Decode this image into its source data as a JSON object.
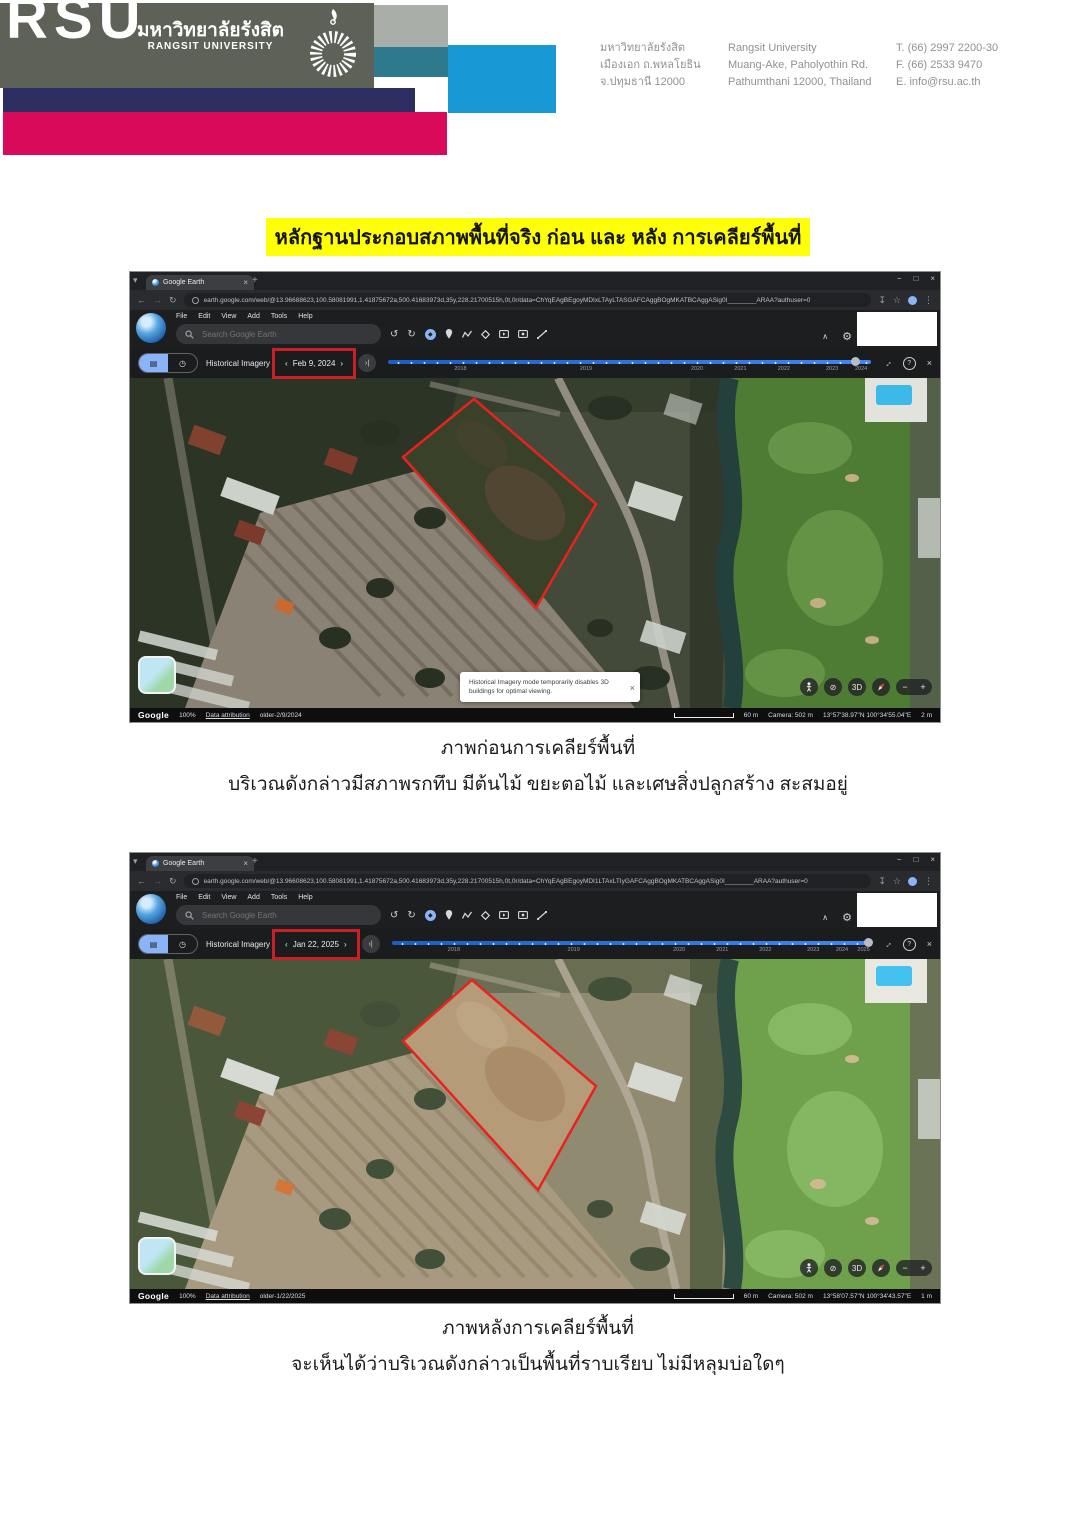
{
  "header": {
    "logo_acronym": "RSU",
    "name_thai": "มหาวิทยาลัยรังสิต",
    "name_en": "RANGSIT UNIVERSITY",
    "address_thai": {
      "l1": "มหาวิทยาลัยรังสิต",
      "l2": "เมืองเอก ถ.พหลโยธิน",
      "l3": "จ.ปทุมธานี 12000"
    },
    "address_en": {
      "l1": "Rangsit University",
      "l2": "Muang-Ake, Paholyothin Rd.",
      "l3": "Pathumthani 12000, Thailand"
    },
    "contact": {
      "l1": "T.  (66) 2997 2200-30",
      "l2": "F.  (66) 2533 9470",
      "l3": "E.  info@rsu.ac.th"
    },
    "colors": {
      "olive": "#5e6157",
      "gray": "#a9aea8",
      "teal": "#2e7a8c",
      "blue": "#1899d6",
      "navy": "#2c2e62",
      "magenta": "#da0a5b",
      "highlight": "#ffff06",
      "annotation_red": "#c91f25",
      "parcel_red": "#e8231d"
    }
  },
  "doc_title": "หลักฐานประกอบสภาพพื้นที่จริง ก่อน และ หลัง การเคลียร์พื้นที่",
  "browser": {
    "tab_title": "Google Earth",
    "menu": [
      "File",
      "Edit",
      "View",
      "Add",
      "Tools",
      "Help"
    ],
    "search_placeholder": "Search Google Earth"
  },
  "shot1": {
    "url": "earth.google.com/web/@13.96688623,100.58081991,1.41875672a,500.41683973d,35y,228.21700515h,0t,0r/data=ChYqEAgBEgoyMDIxLTAyLTASGAFCAggBOgMKATBCAggASig0I________ARAA?authuser=0",
    "mode_label": "Historical Imagery",
    "date": "Feb 9, 2024",
    "timeline_years": [
      "2018",
      "2019",
      "2020",
      "2021",
      "2022",
      "2023",
      "2024"
    ],
    "toast_line1": "Historical Imagery mode temporarily disables 3D",
    "toast_line2": "buildings for optimal viewing.",
    "status": {
      "brand": "Google",
      "zoom": "100%",
      "attribution": "Data attribution",
      "older": "older-2/9/2024",
      "scale": "60 m",
      "camera": "Camera: 502 m",
      "coords": "13°57'38.97\"N 100°34'55.04\"E",
      "altitude": "2 m"
    }
  },
  "shot2": {
    "url": "earth.google.com/web/@13.96608623,100.58081991,1.41875672a,500.41683973d,35y,228.21700515h,0t,0r/data=ChYqEAgBEgoyMDI1LTAxLTIyGAFCAggBOgMKATBCAggASig0I________ARAA?authuser=0",
    "mode_label": "Historical Imagery",
    "date": "Jan 22, 2025",
    "timeline_years": [
      "2018",
      "2019",
      "2020",
      "2021",
      "2022",
      "2023",
      "2024",
      "2025"
    ],
    "status": {
      "brand": "Google",
      "zoom": "100%",
      "attribution": "Data attribution",
      "older": "older-1/22/2025",
      "scale": "60 m",
      "camera": "Camera: 502 m",
      "coords": "13°58'07.57\"N 100°34'43.57\"E",
      "altitude": "1 m"
    }
  },
  "captions": {
    "before_title": "ภาพก่อนการเคลียร์พื้นที่",
    "before_desc": "บริเวณดังกล่าวมีสภาพรกทึบ มีต้นไม้ ขยะตอไม้ และเศษสิ่งปลูกสร้าง สะสมอยู่",
    "after_title": "ภาพหลังการเคลียร์พื้นที่",
    "after_desc": "จะเห็นได้ว่าบริเวณดังกล่าวเป็นพื้นที่ราบเรียบ ไม่มีหลุมบ่อใดๆ"
  },
  "icons": {
    "tab_chevron": "▾",
    "close": "×",
    "new_tab": "+",
    "minimize": "−",
    "maximize": "□",
    "back": "←",
    "forward": "→",
    "reload": "↻",
    "download": "↧",
    "star": "☆",
    "more": "⋮",
    "undo": "↺",
    "redo": "↻",
    "collapse": "∧",
    "gear": "⚙",
    "prev": "‹",
    "next": "›",
    "skip_end": "›|",
    "fullscreen": "↔",
    "help": "?",
    "exit": "×",
    "no3d": "⊘",
    "threed": "3D",
    "minus": "−",
    "plus": "+",
    "layers": "▤",
    "clock": "◷"
  }
}
